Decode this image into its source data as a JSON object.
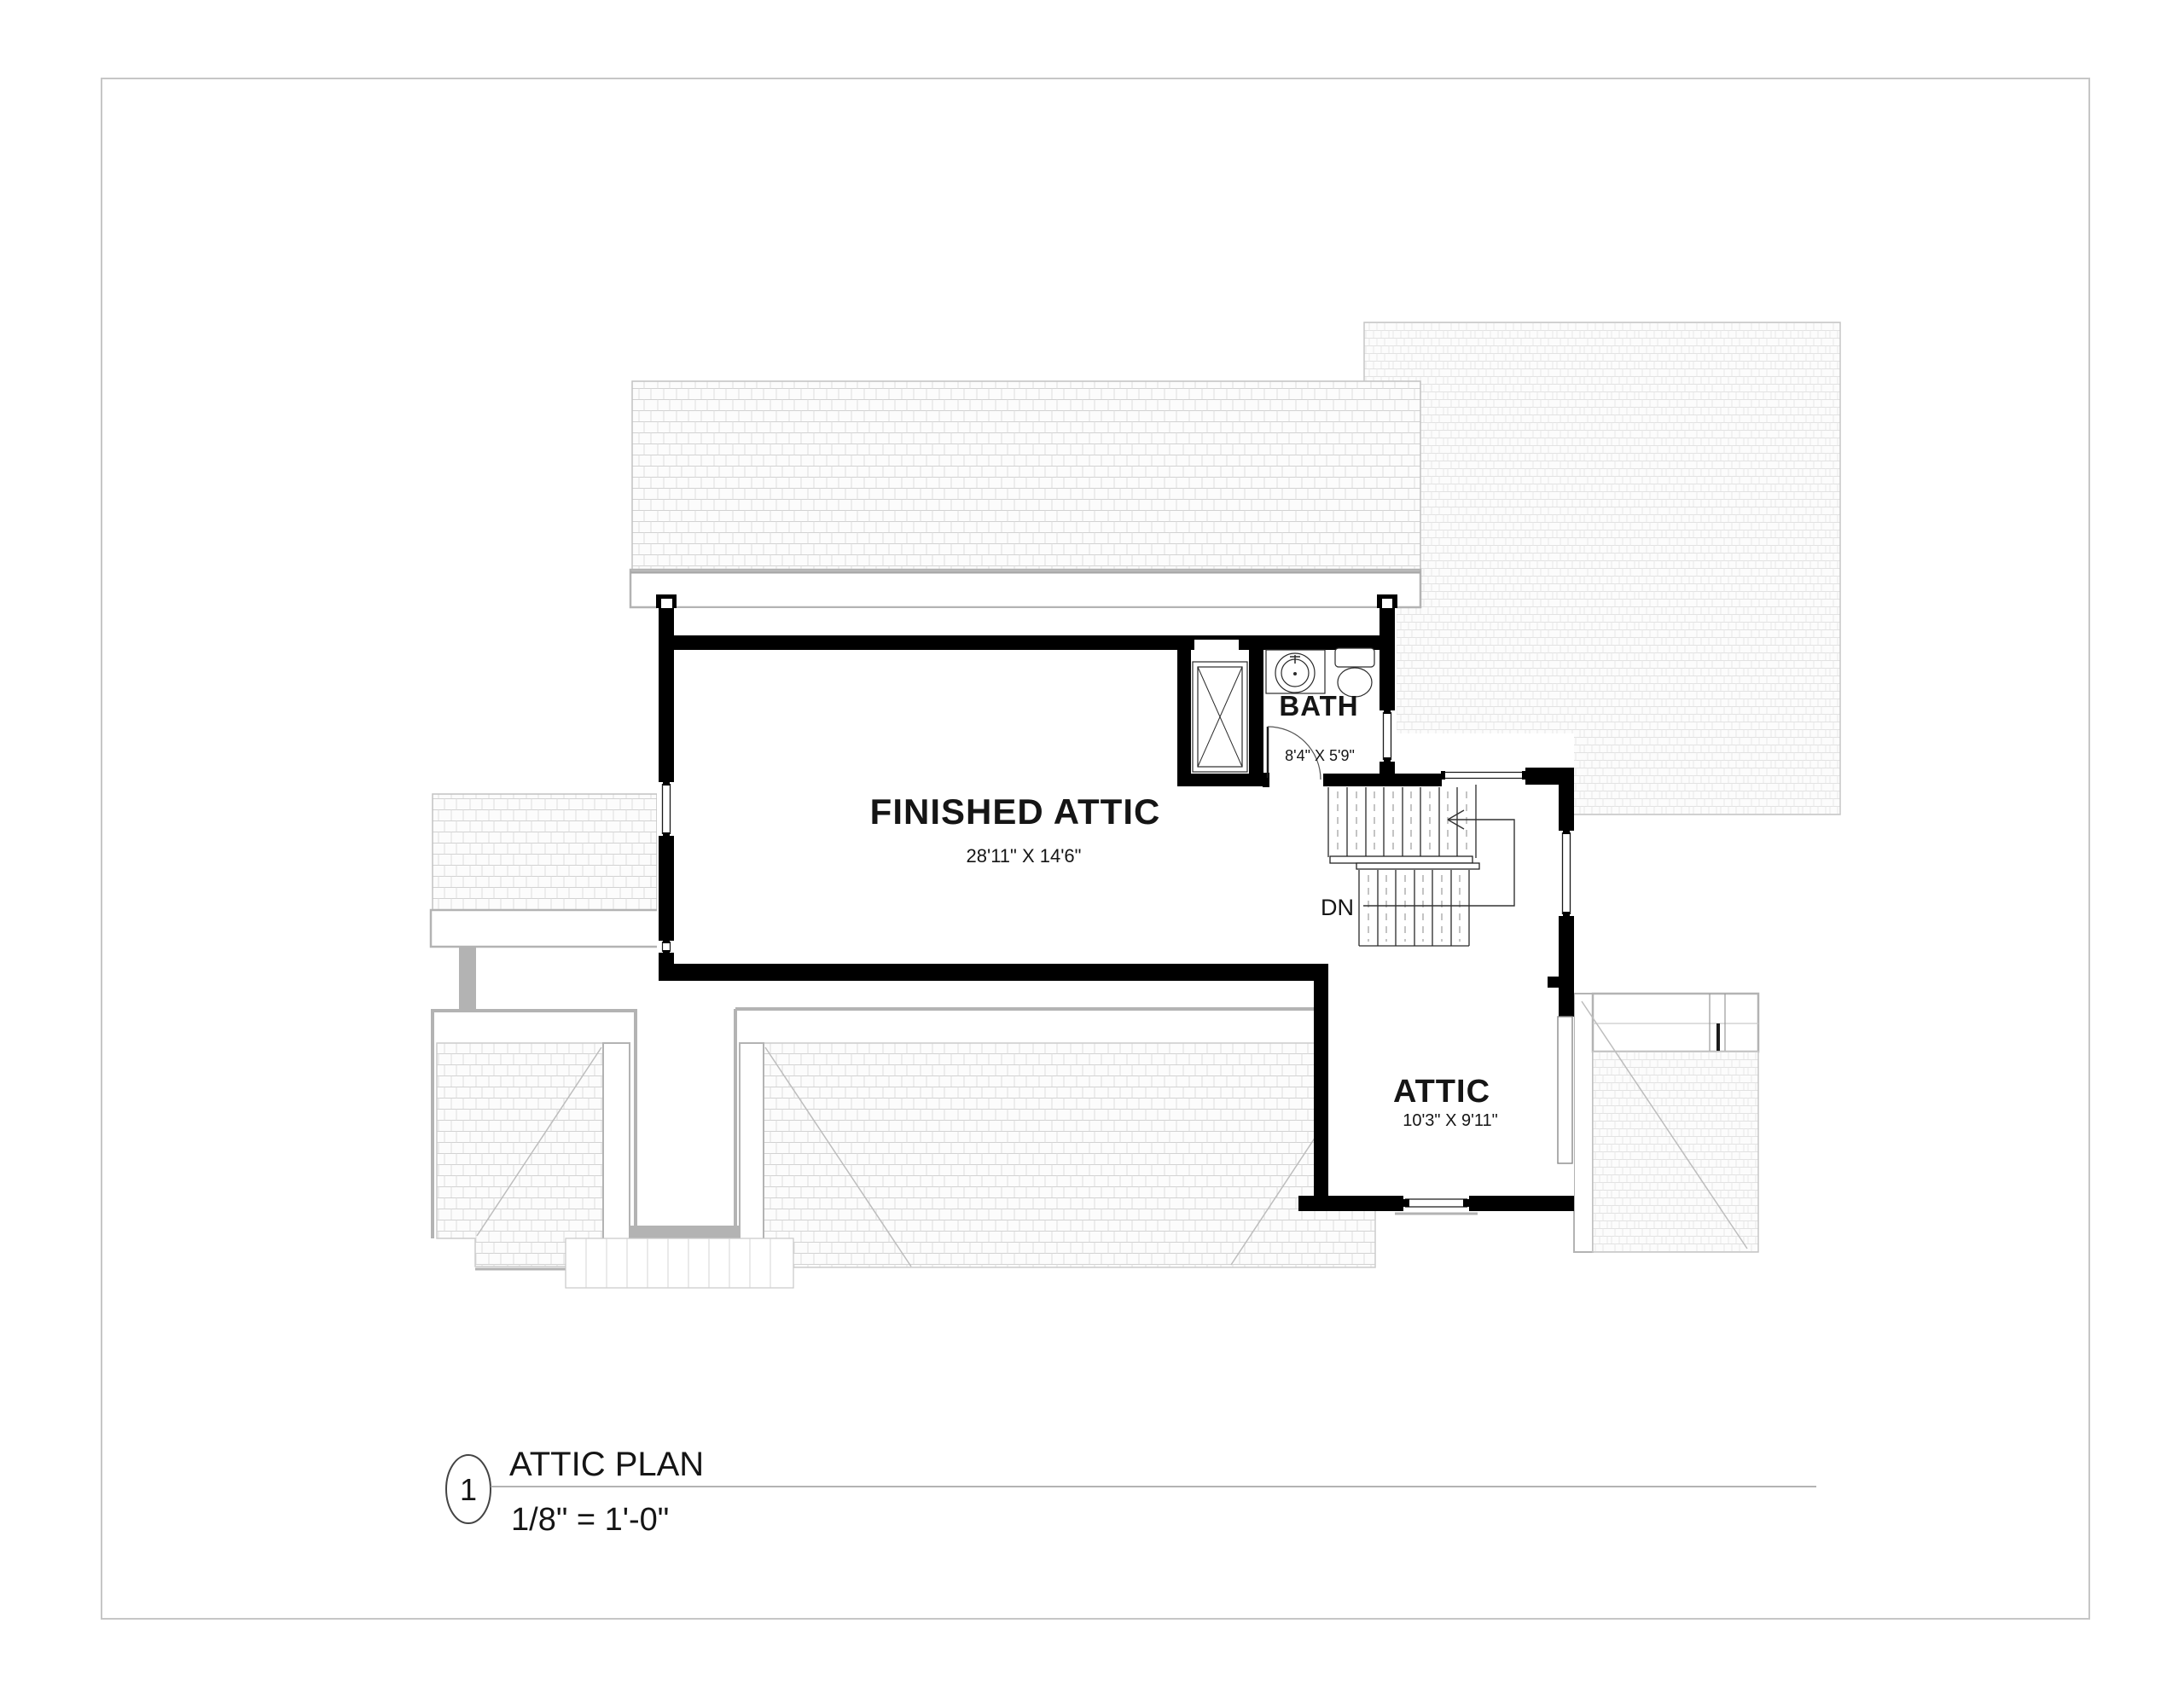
{
  "sheet": {
    "title": "ATTIC PLAN",
    "scale": "1/8\" = 1'-0\"",
    "detail_number": "1"
  },
  "rooms": {
    "finished_attic": {
      "name": "FINISHED ATTIC",
      "dimensions": "28'11\" X 14'6\""
    },
    "bath": {
      "name": "BATH",
      "dimensions": "8'4\" X 5'9\""
    },
    "attic": {
      "name": "ATTIC",
      "dimensions": "10'3\" X 9'11\""
    }
  },
  "stairs": {
    "direction_label": "DN"
  },
  "colors": {
    "wall": "#000000",
    "roof_edge": "#b3b3b3",
    "hatch_line": "#d6d6d6",
    "text": "#151515",
    "page_border": "#c6c6c6"
  }
}
